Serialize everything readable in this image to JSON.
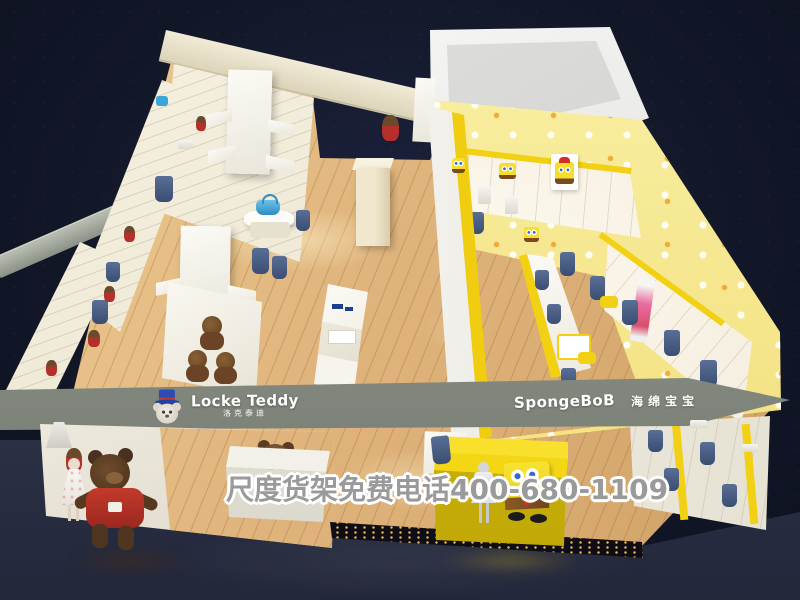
{
  "scene": {
    "type": "3d-store-render",
    "subject": "aerial view of a children's clothing shop with wood floor, white shelving and two brand zones",
    "watermark_text": "尺度货架免费电话400-680-1109"
  },
  "brands": {
    "left": {
      "name_en": "Locke Teddy",
      "name_zh": "洛克泰迪",
      "logo_icon": "teddy-bear-top-hat-icon"
    },
    "right": {
      "name_en": "SpongeBoB",
      "name_zh": "海绵宝宝",
      "mascot_icon": "spongebob-icon"
    }
  },
  "palette": {
    "background_navy": "#121729",
    "foreground_floor": "#2e3246",
    "wood_floor": "#e0b57d",
    "wall_cream": "#efe9d6",
    "shelf_white": "#f7f5ee",
    "fascia_gray_green": "#8a9086",
    "accent_yellow": "#f2d013",
    "wallpaper_pale_yellow": "#f7ec9b",
    "denim_blue": "#44587e",
    "teddy_brown": "#5d4028",
    "sweater_red": "#b5302a",
    "spongebob_yellow": "#f6df2a",
    "logo_hat_blue": "#2b4bb5"
  }
}
